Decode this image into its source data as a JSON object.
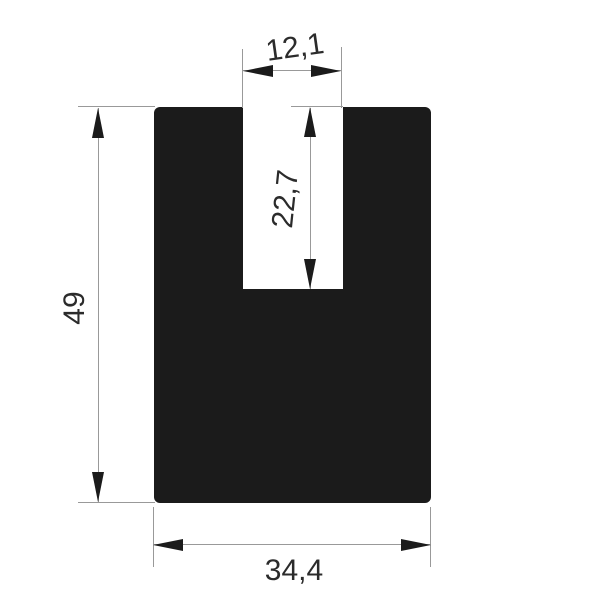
{
  "drawing": {
    "type": "technical-dimension-drawing",
    "shape_name": "U-profile cross-section",
    "colors": {
      "background": "#ffffff",
      "profile_fill": "#1b1b1b",
      "dimension_line": "#999999",
      "arrow": "#1b1b1b",
      "text": "#2b2b2b"
    },
    "dimensions": {
      "slot_width": {
        "label": "12,1"
      },
      "slot_depth": {
        "label": "22,7"
      },
      "overall_height": {
        "label": "49"
      },
      "overall_width": {
        "label": "34,4"
      }
    }
  }
}
